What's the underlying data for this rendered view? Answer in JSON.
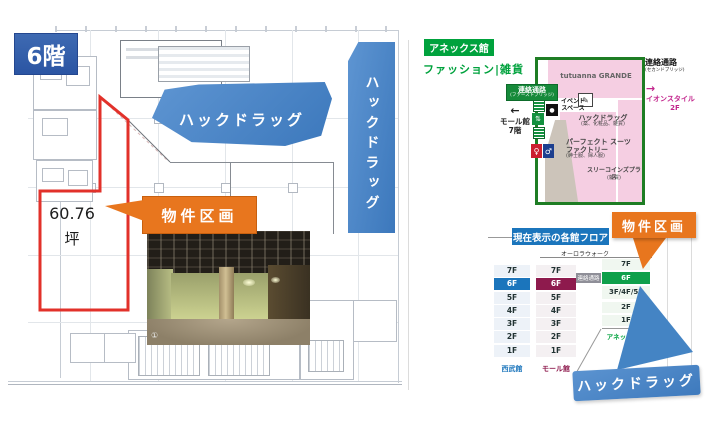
{
  "left_panel": {
    "floor_badge": "6階",
    "area_value": "60.76",
    "area_unit": "坪",
    "hackdrug_callout": "ハックドラッグ",
    "hackdrug_vertical": "ハックドラッグ",
    "property_callout": "物件区画",
    "photo_marker": "①"
  },
  "right_panel": {
    "building_badge": "アネックス館",
    "category_label": "ファッション|雑貨",
    "map": {
      "tutuanna": "tutuanna GRANDE",
      "event_space_line1": "イベント",
      "event_space_line2": "スペース",
      "pencil_glyph": "✎",
      "camera_glyph": "●",
      "hack_name": "ハックドラッグ",
      "hack_category": "(薬、化粧品、雑貨)",
      "suits_line1": "パーフェクト スーツ",
      "suits_line2": "ファクトリー",
      "suits_category": "(紳士服、婦人服)",
      "threecoins_name": "スリーコインズプラス",
      "threecoins_category": "(雑貨)",
      "corridor_first_line1": "連絡通路",
      "corridor_first_line2": "(ファーストブリッジ)",
      "mall_arrow": "←",
      "mall_line1": "モール館",
      "mall_line2": "7階",
      "corridor_second_line1": "連絡通路",
      "corridor_second_line2": "(セカンドブリッジ)",
      "aeon_arrow": "→",
      "aeon_line1": "イオンスタイル",
      "aeon_line2": "2F",
      "wc_female": "♀",
      "wc_male": "♂",
      "escalator_glyph": "⇅"
    },
    "floor_table": {
      "header": "現在表示の各館フロア",
      "aurora_walk": "オーロラウォーク",
      "corridor_badge": "連絡通路",
      "seibu_label": "西武館",
      "seibu_floors": [
        "7F",
        "6F",
        "5F",
        "4F",
        "3F",
        "2F",
        "1F"
      ],
      "mall_label": "モール館",
      "mall_floors": [
        "7F",
        "6F",
        "5F",
        "4F",
        "3F",
        "2F",
        "1F"
      ],
      "annex_label": "アネックス館",
      "annex_floors": [
        "7F",
        "6F",
        "3F/4F/5F",
        "2F",
        "1F"
      ]
    },
    "property_callout": "物件区画",
    "hackdrug_callout": "ハックドラッグ"
  },
  "colors": {
    "blue_callout": "#4484C4",
    "dark_blue_badge": "#2F5CA8",
    "orange_callout": "#E8761E",
    "red_outline": "#E2312A",
    "green_primary": "#00A23D",
    "map_border_green": "#1E7D24",
    "pink_store": "#F5CEE2",
    "seibu_highlight": "#1B75BC",
    "mall_highlight": "#8E1A4D",
    "annex_highlight": "#0FA04B"
  }
}
